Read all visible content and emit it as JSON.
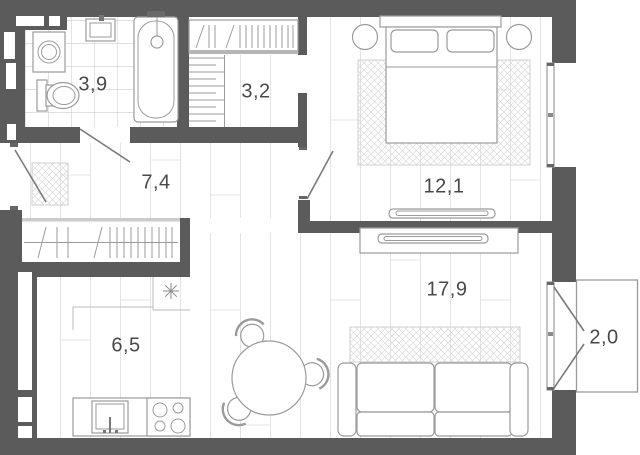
{
  "plan": {
    "type": "apartment-floor-plan",
    "rooms": [
      {
        "id": "bathroom",
        "area": "3,9"
      },
      {
        "id": "wardrobe",
        "area": "3,2"
      },
      {
        "id": "hallway",
        "area": "7,4"
      },
      {
        "id": "bedroom",
        "area": "12,1"
      },
      {
        "id": "kitchen",
        "area": "6,5"
      },
      {
        "id": "living-room",
        "area": "17,9"
      },
      {
        "id": "balcony",
        "area": "2,0"
      }
    ],
    "fixtures": [
      "washing-machine",
      "bathroom-sink",
      "toilet",
      "bathtub",
      "shower-head",
      "clothes-rail",
      "shelving",
      "hallway-wardrobe",
      "doormat",
      "double-bed",
      "pillows",
      "nightstand",
      "bedroom-rug",
      "tv-low-console",
      "tv-stand",
      "tv",
      "living-rug",
      "sofa",
      "dining-table",
      "dining-chair",
      "kitchen-counter",
      "kitchen-sink",
      "stove-4-burners",
      "ceiling-point-symbol",
      "entrance-door",
      "bathroom-door",
      "bedroom-door",
      "window",
      "balcony"
    ],
    "colors": {
      "wall": "#5b5b5b",
      "outline": "#9b9b9b",
      "plank": "#e4e4e4",
      "tile": "#c2c2c2",
      "rughatch": "#dadada",
      "door": "#7a7a7a",
      "track": "#cbcbcb",
      "label": "#494949"
    }
  }
}
